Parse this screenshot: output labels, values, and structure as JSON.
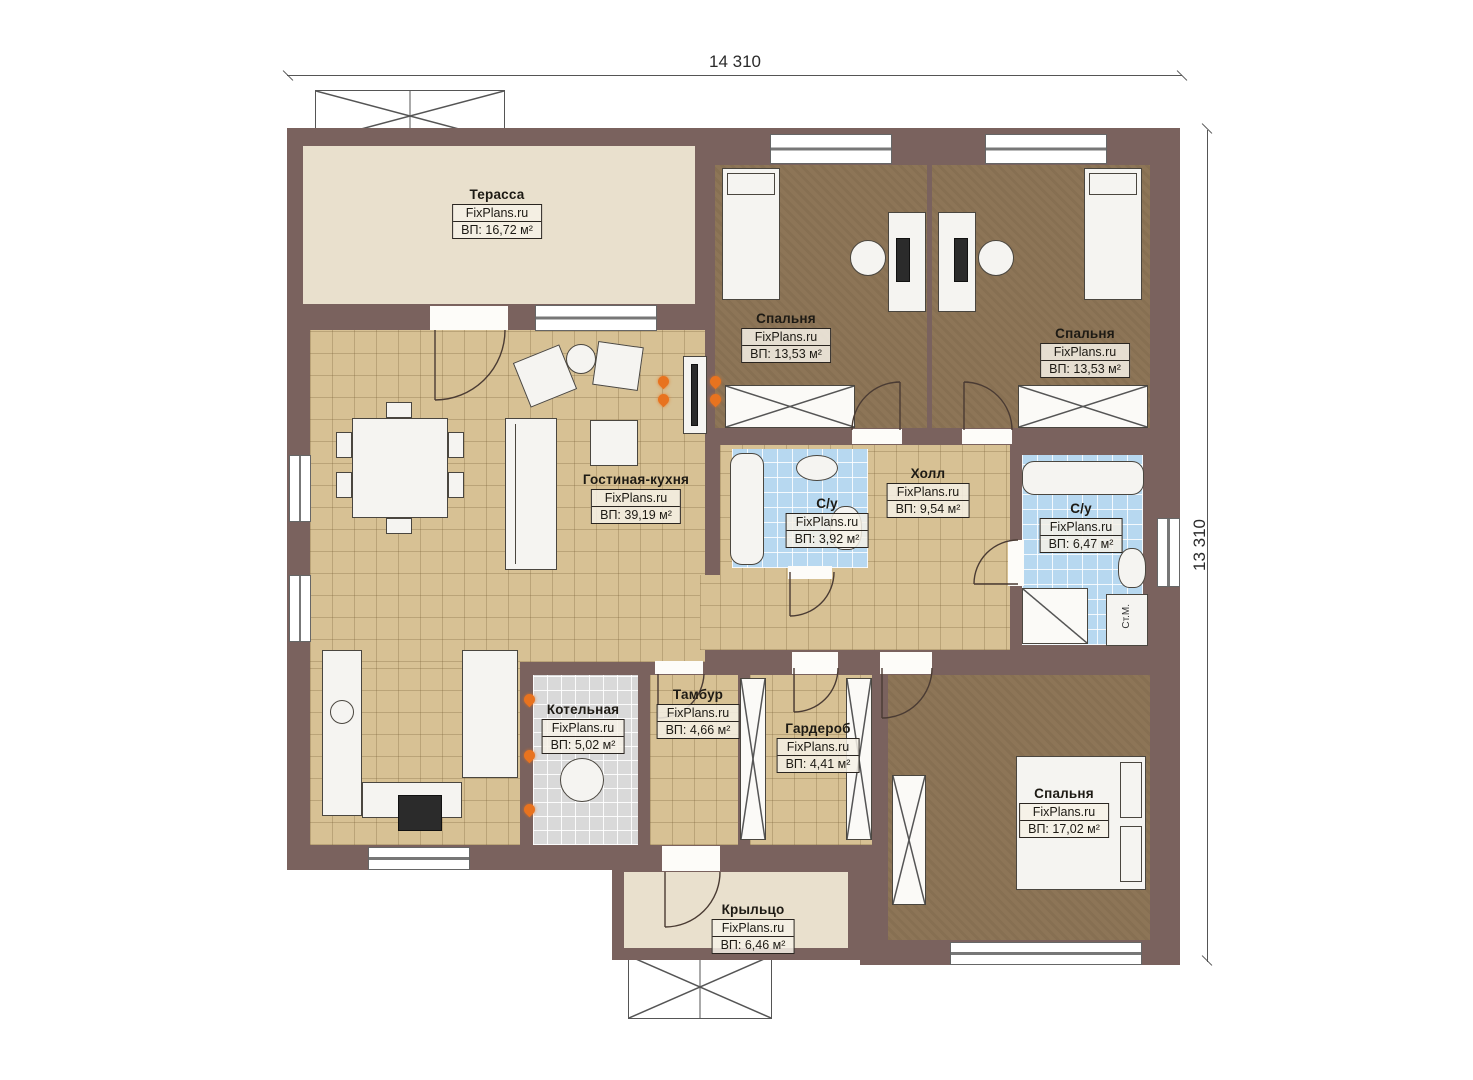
{
  "dimensions": {
    "width_label": "14 310",
    "height_label": "13 310"
  },
  "rooms": [
    {
      "id": "terrace",
      "name": "Терасса",
      "brand": "FixPlans.ru",
      "area": "ВП: 16,72 м²"
    },
    {
      "id": "bedroom1",
      "name": "Спальня",
      "brand": "FixPlans.ru",
      "area": "ВП: 13,53 м²"
    },
    {
      "id": "bedroom2",
      "name": "Спальня",
      "brand": "FixPlans.ru",
      "area": "ВП: 13,53 м²"
    },
    {
      "id": "living",
      "name": "Гостиная-кухня",
      "brand": "FixPlans.ru",
      "area": "ВП: 39,19 м²"
    },
    {
      "id": "bath1",
      "name": "С/у",
      "brand": "FixPlans.ru",
      "area": "ВП: 3,92 м²"
    },
    {
      "id": "hall",
      "name": "Холл",
      "brand": "FixPlans.ru",
      "area": "ВП: 9,54 м²"
    },
    {
      "id": "bath2",
      "name": "С/у",
      "brand": "FixPlans.ru",
      "area": "ВП: 6,47 м²"
    },
    {
      "id": "boiler",
      "name": "Котельная",
      "brand": "FixPlans.ru",
      "area": "ВП: 5,02 м²"
    },
    {
      "id": "tambur",
      "name": "Тамбур",
      "brand": "FixPlans.ru",
      "area": "ВП: 4,66 м²"
    },
    {
      "id": "wardrobe",
      "name": "Гардероб",
      "brand": "FixPlans.ru",
      "area": "ВП: 4,41 м²"
    },
    {
      "id": "bedroom3",
      "name": "Спальня",
      "brand": "FixPlans.ru",
      "area": "ВП: 17,02 м²"
    },
    {
      "id": "porch",
      "name": "Крыльцо",
      "brand": "FixPlans.ru",
      "area": "ВП: 6,46 м²"
    }
  ],
  "labels": {
    "washing_machine": "Ст.М."
  },
  "colors": {
    "wall": "#7a625e",
    "floor_tan": "#d7c194",
    "floor_brown": "#8d7557",
    "floor_blue": "#b7d8f0",
    "floor_gray": "#d9d9d9",
    "floor_beige": "#e9e0cd",
    "flame_accent": "#e8731f"
  }
}
